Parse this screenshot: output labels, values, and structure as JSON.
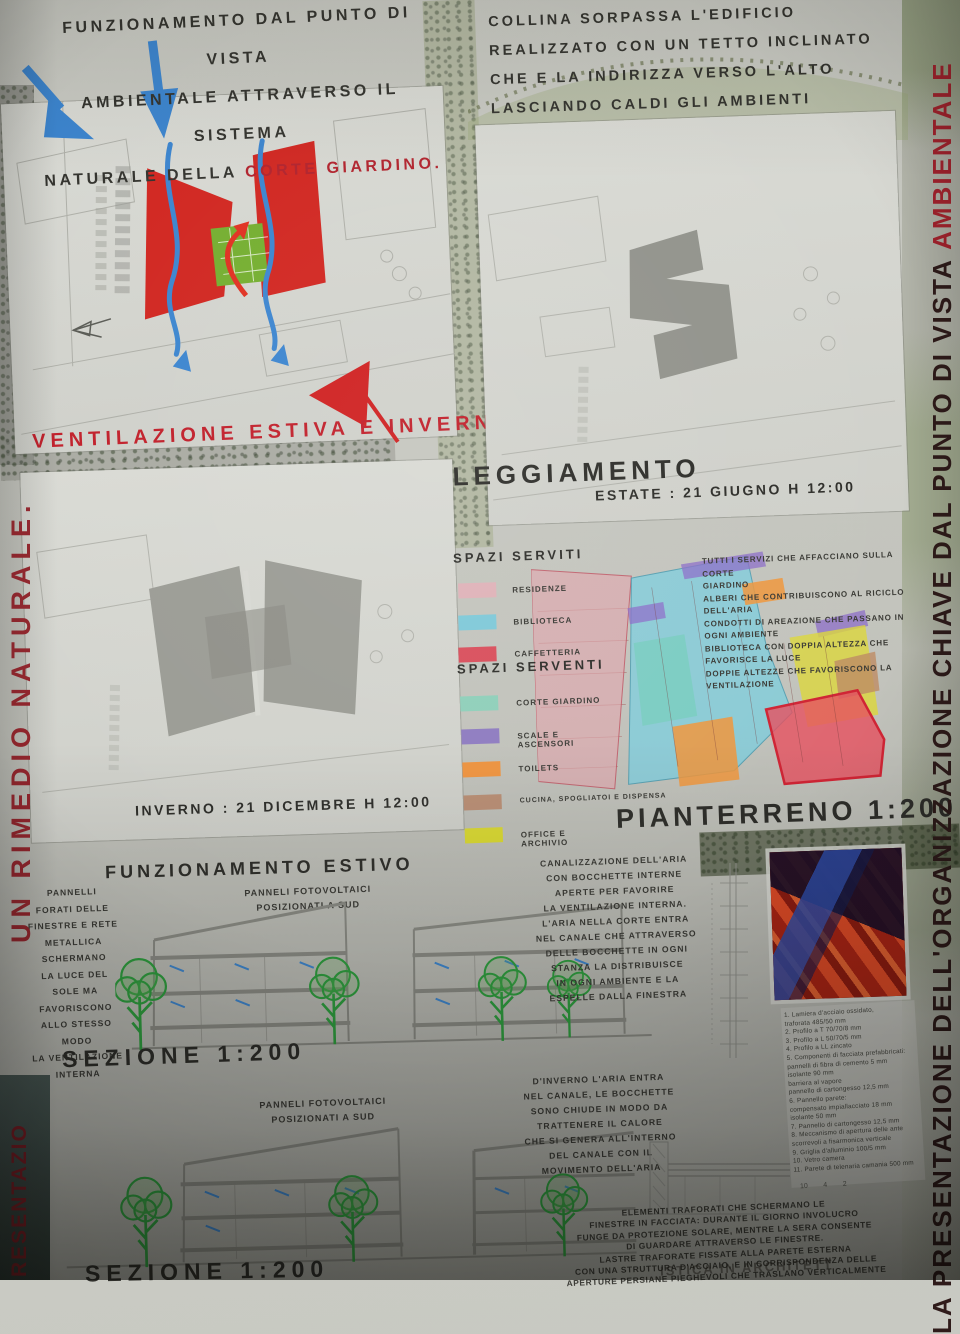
{
  "intro": {
    "left_line1": "FUNZIONAMENTO DAL PUNTO DI VISTA",
    "left_line2": "AMBIENTALE ATTRAVERSO IL SISTEMA",
    "left_line3": "NATURALE DELLA",
    "left_line3_accent": "CORTE GIARDINO.",
    "right": "COLLINA SORPASSA L'EDIFICIO\nREALIZZATO CON UN TETTO INCLINATO\nCHE E LA INDIRIZZA VERSO L'ALTO\nLASCIANDO CALDI GLI AMBIENTI\nSOTTOSTANTI."
  },
  "ventilation": {
    "title": "VENTILAZIONE ESTIVA E INVERNALE"
  },
  "sunlight": {
    "title": "SOLEGGIAMENTO",
    "summer_label": "ESTATE : 21 GIUGNO H 12:00",
    "winter_label": "INVERNO : 21 DICEMBRE H 12:00"
  },
  "ground_floor": {
    "title": "PIANTERRENO 1:200",
    "served_title": "SPAZI SERVITI",
    "served": [
      {
        "label": "RESIDENZE",
        "color": "#dfb2b8"
      },
      {
        "label": "BIBLIOTECA",
        "color": "#7fc9d8"
      },
      {
        "label": "CAFFETTERIA",
        "color": "#d94f5c"
      }
    ],
    "serving_title": "SPAZI SERVENTI",
    "serving": [
      {
        "label": "CORTE GIARDINO",
        "color": "#8fcfba"
      },
      {
        "label": "SCALE E ASCENSORI",
        "color": "#8f7cc0"
      },
      {
        "label": "TOILETS",
        "color": "#ef9440"
      },
      {
        "label": "CUCINA, SPOGLIATOI E DISPENSA",
        "color": "#b98e74"
      },
      {
        "label": "OFFICE E ARCHIVIO",
        "color": "#d9d832"
      }
    ],
    "notes": "TUTTI I SERVIZI CHE AFFACCIANO SULLA CORTE\nGIARDINO\nALBERI CHE CONTRIBUISCONO AL RICICLO\nDELL'ARIA\nCONDOTTI DI AREAZIONE CHE PASSANO IN\nOGNI AMBIENTE\nBIBLIOTECA CON DOPPIA ALTEZZA CHE\nFAVORISCE LA LUCE\nDOPPIE ALTEZZE CHE FAVORISCONO LA\nVENTILAZIONE"
  },
  "summer_operation": {
    "title": "FUNZIONAMENTO ESTIVO",
    "panel_note": "PANNELLI\nFORATI DELLE\nFINESTRE E RETE\nMETALLICA\nSCHERMANO\nLA LUCE DEL\nSOLE MA\nFAVORISCONO\nALLO STESSO\nMODO\nLA VENTILAZIONE\nINTERNA",
    "pv_note": "PANNELI FOTOVOLTAICI\nPOSIZIONATI A SUD",
    "air_note": "CANALIZZAZIONE DELL'ARIA\nCON BOCCHETTE INTERNE\nAPERTE PER FAVORIRE\nLA VENTILAZIONE INTERNA.\nL'ARIA NELLA CORTE ENTRA\nNEL CANALE CHE ATTRAVERSO\nDELLE BOCCHETTE IN OGNI\nSTANZA LA DISTRIBUISCE\nIN OGNI AMBIENTE E LA\nESPELLE DALLA FINESTRA",
    "section_label": "SEZIONE 1:200"
  },
  "winter_operation": {
    "pv_note": "PANNELI FOTOVOLTAICI\nPOSIZIONATI A SUD",
    "air_note": "D'INVERNO L'ARIA ENTRA\nNEL CANALE, LE BOCCHETTE\nSONO CHIUDE IN MODO DA\nTRATTENERE IL CALORE\nCHE SI GENERA ALL'INTERNO\nDEL CANALE CON IL\nMOVIMENTO DELL'ARIA",
    "facade_note": "ELEMENTI TRAFORATI CHE SCHERMANO LE\nFINESTRE IN FACCIATA: DURANTE IL GIORNO INVOLUCRO\nFUNGE DA PROTEZIONE SOLARE, MENTRE LA SERA CONSENTE\nDI GUARDARE ATTRAVERSO LE FINESTRE.\nLASTRE TRAFORATE FISSATE ALLA PARETE ESTERNA\nCON UNA STRUTTURA D'ACCIAIO, E IN CORRISPONDENZA DELLE\nAPERTURE PERSIANE PIEGHEVOLI CHE TRASLANO VERTICALMENTE",
    "section_label": "SEZIONE 1:200"
  },
  "materials_list": "1. Lamiera d'acciaio ossidato,\n    traforata 485/50 mm\n2. Profilo a T 70/70/8 mm\n3. Profilo a L 50/70/5 mm\n4. Profilo a LL zincato\n5. Componenti di facciata prefabbricati:\n    pannelli di fibra di cemento 5 mm\n    isolante 90 mm\n    barriera al vapore\n    pannello di cartongesso 12,5 mm\n6. Pannello parete:\n    compensato impiallacciato 18 mm\n    isolante 50 mm\n7. Pannello di cartongesso 12,5 mm\n8. Meccanismo di apertura delle ante\n    scorrevoli a fisarmonica verticale\n9. Griglia d'alluminio 100/5 mm\n10. Vetro camera\n11. Parete di telenaria camania 500 mm",
  "detail_callouts": "10        4        2",
  "footer_fragment": "ISTICA IN ARCHITETT",
  "side_banners": {
    "right_main": "LA PRESENTAZIONE DELL'ORGANIZZAZIONE CHIAVE DAL PUNTO DI VISTA ",
    "right_accent": "AMBIENTALE",
    "left": "UN RIMEDIO NATURALE.",
    "bottom_left": "PRESENTAZIO"
  },
  "colors": {
    "accent_red": "#b1222c",
    "drawing_red": "#cf2020",
    "arrow_blue": "#3c85cf",
    "courtyard_green": "#74ae2f",
    "shadow_gray": "#9b9c95"
  }
}
